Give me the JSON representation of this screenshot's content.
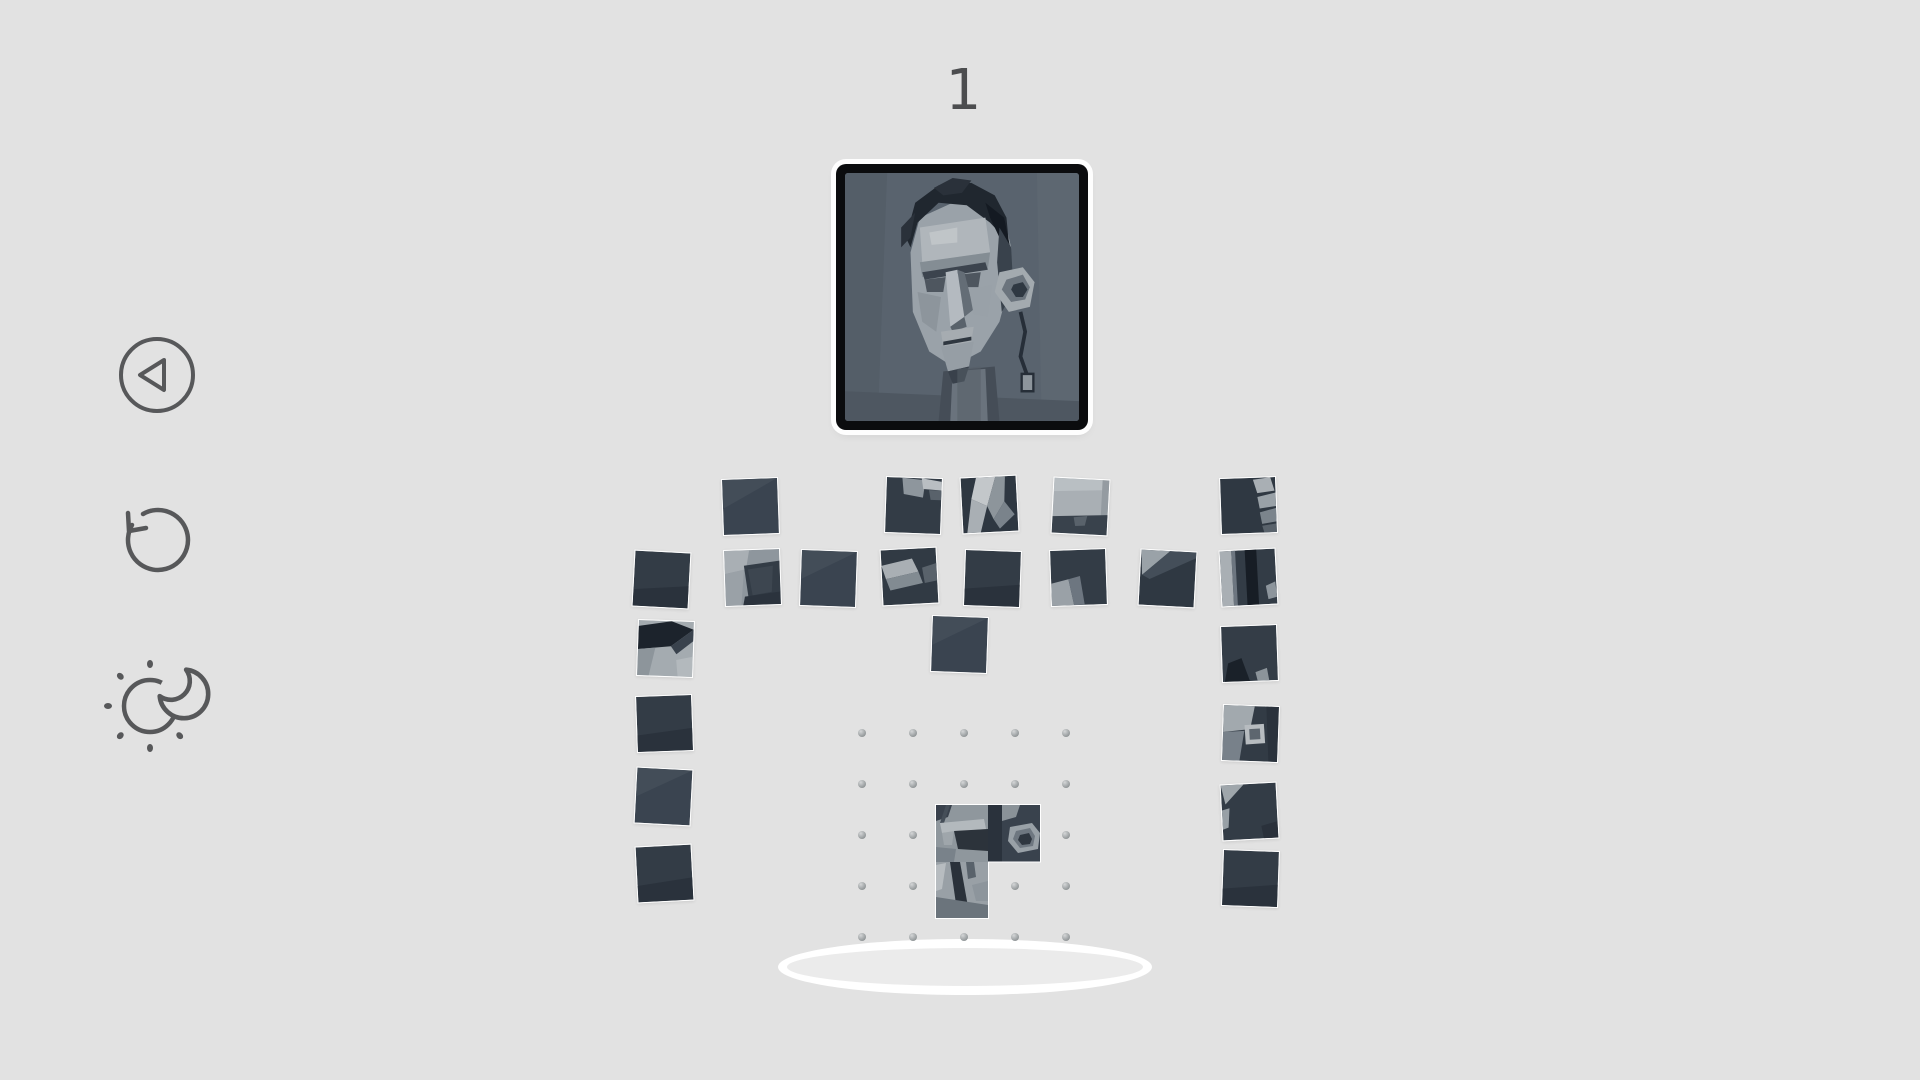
{
  "hud": {
    "counter": "1"
  },
  "toolbar": {
    "icons": [
      "back-icon",
      "restart-icon",
      "day-night-icon"
    ]
  },
  "reference_image": "cubist-sculpture-head",
  "colors": {
    "background": "#e2e2e2",
    "icon_stroke": "#57585a",
    "counter_text": "#4c4d4f",
    "tile_dark": "#39434e",
    "tile_light": "#a9afb4",
    "frame_black": "#0b0c0e",
    "platform_white": "#ffffff",
    "dot_gray": "#8f9496"
  },
  "board": {
    "grid": {
      "cols": 5,
      "rows": 5,
      "origin_x": 862,
      "origin_y": 733,
      "spacing": 51
    },
    "placed_cells": [
      [
        3,
        3
      ],
      [
        3,
        4
      ],
      [
        4,
        3
      ]
    ]
  },
  "pieces": [
    {
      "x": 722,
      "y": 478,
      "rot": -2,
      "variant": "plain_a"
    },
    {
      "x": 885,
      "y": 477,
      "rot": 2,
      "variant": "block_top"
    },
    {
      "x": 961,
      "y": 476,
      "rot": -3,
      "variant": "wedge"
    },
    {
      "x": 1052,
      "y": 478,
      "rot": 3,
      "variant": "light_plane"
    },
    {
      "x": 1220,
      "y": 477,
      "rot": -2,
      "variant": "edge_light"
    },
    {
      "x": 633,
      "y": 551,
      "rot": 3,
      "variant": "plain_b"
    },
    {
      "x": 724,
      "y": 549,
      "rot": -2,
      "variant": "panels"
    },
    {
      "x": 800,
      "y": 550,
      "rot": 2,
      "variant": "plain_a"
    },
    {
      "x": 881,
      "y": 548,
      "rot": -3,
      "variant": "wedge2"
    },
    {
      "x": 964,
      "y": 550,
      "rot": 2,
      "variant": "plain_b"
    },
    {
      "x": 1050,
      "y": 549,
      "rot": -2,
      "variant": "frag_bl"
    },
    {
      "x": 1139,
      "y": 550,
      "rot": 3,
      "variant": "diag_tl"
    },
    {
      "x": 1220,
      "y": 549,
      "rot": -3,
      "variant": "bands"
    },
    {
      "x": 637,
      "y": 620,
      "rot": 2,
      "variant": "hair_diag"
    },
    {
      "x": 636,
      "y": 695,
      "rot": -2,
      "variant": "plain_b"
    },
    {
      "x": 635,
      "y": 768,
      "rot": 3,
      "variant": "plain_a"
    },
    {
      "x": 636,
      "y": 845,
      "rot": -3,
      "variant": "plain_b"
    },
    {
      "x": 931,
      "y": 616,
      "rot": 2,
      "variant": "plain_a"
    },
    {
      "x": 1221,
      "y": 625,
      "rot": -2,
      "variant": "spike_bl"
    },
    {
      "x": 1222,
      "y": 705,
      "rot": 2,
      "variant": "ear_box"
    },
    {
      "x": 1221,
      "y": 783,
      "rot": -3,
      "variant": "diag_tl2"
    },
    {
      "x": 1222,
      "y": 850,
      "rot": 2,
      "variant": "plain_b"
    }
  ]
}
